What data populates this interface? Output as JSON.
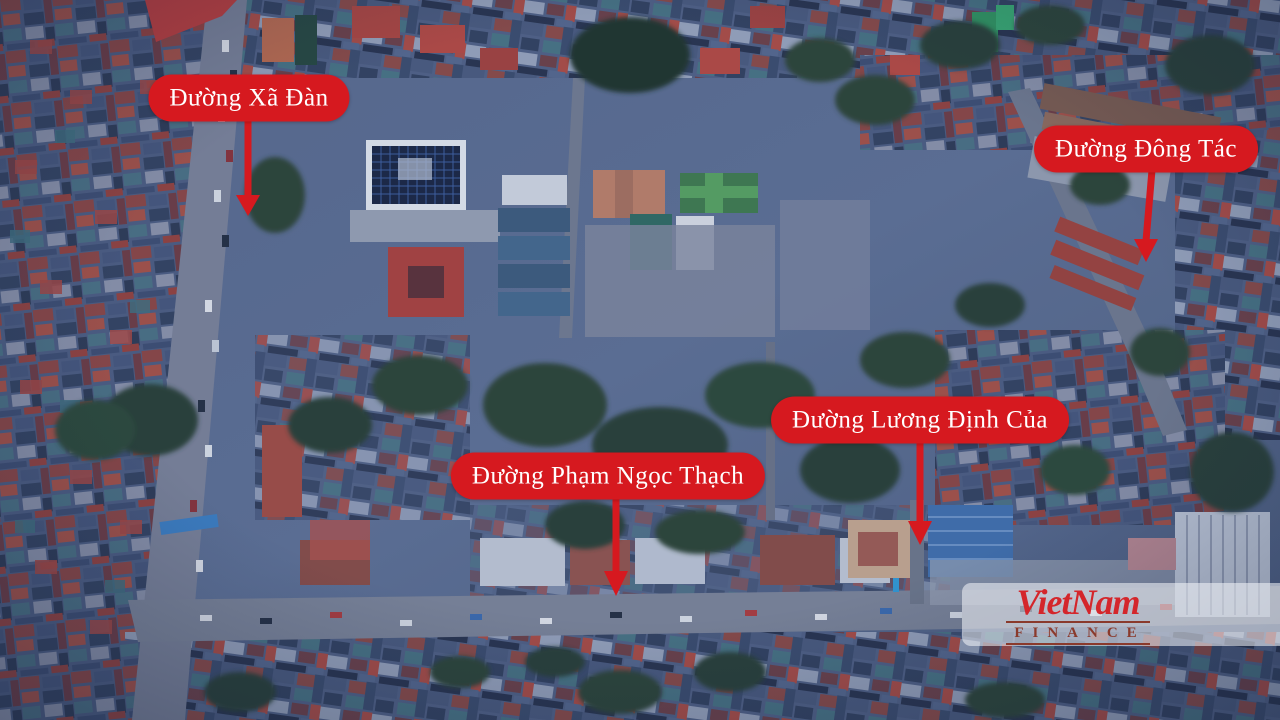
{
  "theme": {
    "accent-red": "#d6191f",
    "brand-red": "#d4262b",
    "finance-red": "#8a3a2c",
    "label-text": "#ffffff"
  },
  "street_labels": [
    {
      "text": "Đường Xã Đàn"
    },
    {
      "text": "Đường Đông Tác"
    },
    {
      "text": "Đường Lương Định Của"
    },
    {
      "text": "Đường Phạm Ngọc Thạch"
    }
  ],
  "watermark": {
    "brand": "VietNam",
    "subtitle": "FINANCE"
  }
}
